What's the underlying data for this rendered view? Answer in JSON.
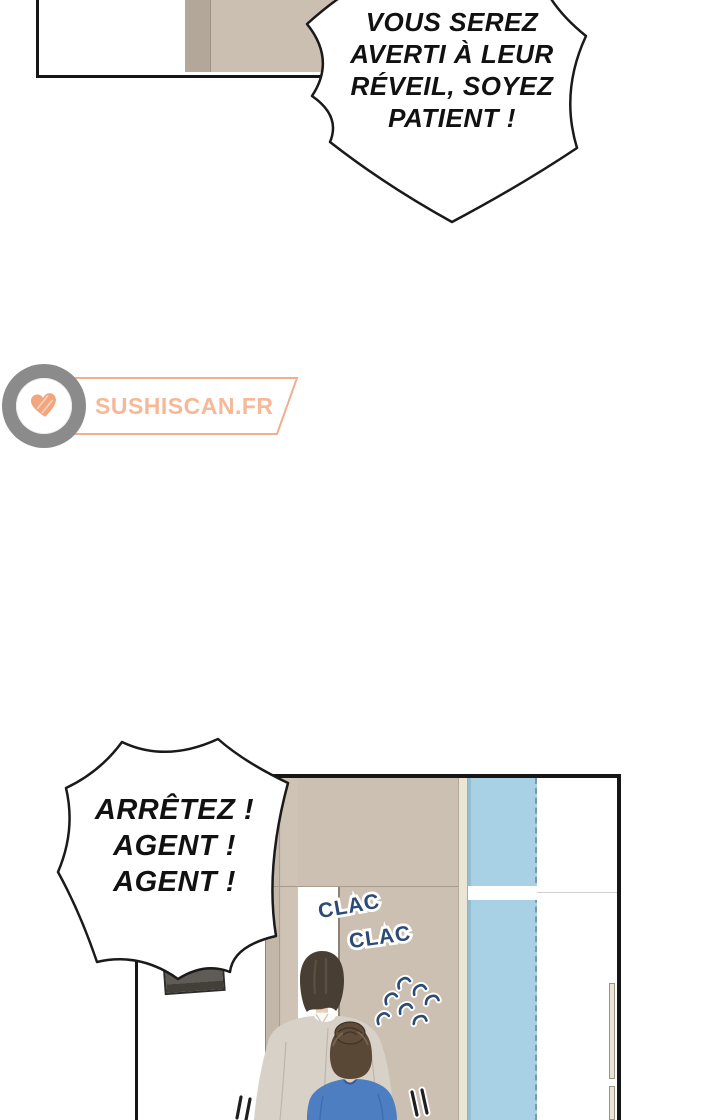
{
  "speech_bubbles": {
    "top": {
      "lines": [
        "VOUS SEREZ",
        "AVERTI À LEUR",
        "RÉVEIL, SOYEZ",
        "PATIENT !"
      ]
    },
    "bottom": {
      "lines": [
        "ARRÊTEZ !",
        "AGENT !",
        "AGENT !"
      ]
    }
  },
  "sfx": {
    "clac_first": "CLAC",
    "clac_second": "CLAC",
    "text_color": "#2b4a75",
    "outline_color": "#ffffff",
    "motion_scribble_count": 7,
    "emphasis_dash_pairs": 2
  },
  "watermark": {
    "text": "SUSHISCAN.FR",
    "text_color": "#f6b897",
    "banner_outline_color": "#f2ae8e",
    "logo_ring_color": "#8b8b8b",
    "logo_center_color": "#ffffff",
    "heart_color": "#f1a67e"
  },
  "scene_colors": {
    "panel_border": "#161616",
    "wall_tan_light": "#cbbfb1",
    "wall_tan_dark": "#b2a799",
    "wall_beige": "#ccc0b3",
    "window_glass_blue": "#a8d1e6",
    "window_frame_cream": "#ebe5d5",
    "monitor_gray": "#5f5b56",
    "monitor_stripe_blue": "#a3cbdd",
    "coat_greige": "#d8d1c8",
    "shirt_white": "#fbfaf7",
    "blouse_blue": "#4d7ec2",
    "man_hair_brown": "#493e33",
    "woman_bun_brown": "#594836",
    "skin": "#e9cdb4"
  }
}
